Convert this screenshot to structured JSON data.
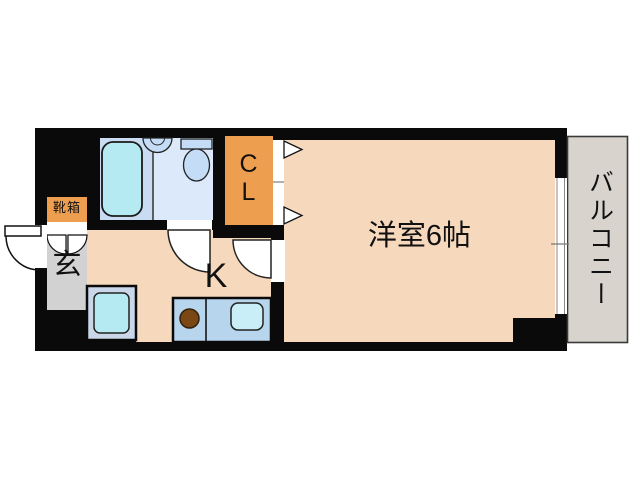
{
  "floorplan": {
    "type": "apartment-1K-floor-plan",
    "labels": {
      "main_room": "洋室6帖",
      "kitchen": "K",
      "entrance": "玄",
      "shoe_box": "靴箱",
      "closet_line1": "C",
      "closet_line2": "L",
      "balcony": "バルコニー"
    },
    "colors": {
      "wall_black": "#0a0a0a",
      "floor_peach": "#f6d8bc",
      "closet_orange": "#ee9e4f",
      "entrance_gray": "#d2d2d2",
      "balcony_gray": "#d8d4cd",
      "bath_area_blue": "#c9dcf1",
      "vanity_area_blue": "#dbe9fa",
      "fixture_cyan": "#b6eaf3",
      "fixture_blue": "#c5dcf6",
      "counter_blue": "#b7d5ec",
      "sink_cyan": "#c9eef8",
      "stove_brown": "#7a4715",
      "background": "#ffffff"
    },
    "fixtures": [
      "bathtub",
      "wash-basin",
      "toilet",
      "closet-folding-door-arrows",
      "entrance-door-swing",
      "shoe-cabinet-doors",
      "washing-machine",
      "kitchen-counter",
      "stove-burner",
      "kitchen-sink",
      "bathroom-door-swing",
      "kitchen-door-swing",
      "sliding-window",
      "pillar"
    ]
  }
}
